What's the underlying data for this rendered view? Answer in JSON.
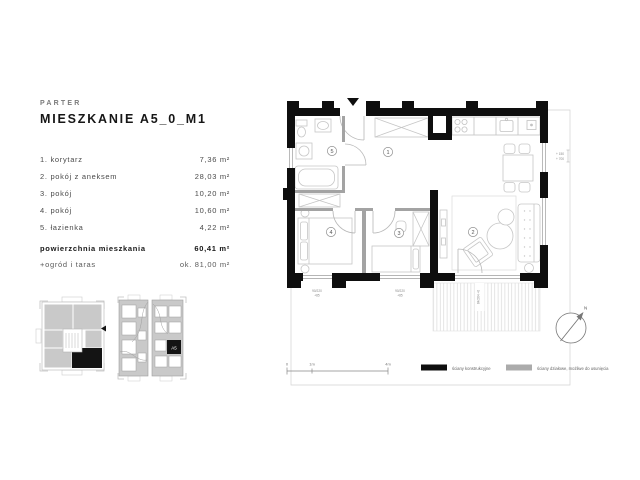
{
  "colors": {
    "ink": "#161616",
    "muted_gray": "#7b7b7b",
    "structural_wall": "#0e0e0e",
    "partition_wall": "#a3a3a3",
    "furniture_line": "#c6c6c6",
    "thumb_gray": "#c9c9c9"
  },
  "panel": {
    "floor_label": "PARTER",
    "title": "MIESZKANIE A5_0_M1",
    "rooms": [
      {
        "name": "1. korytarz",
        "area": "7,36 m²"
      },
      {
        "name": "2. pokój z aneksem",
        "area": "28,03 m²"
      },
      {
        "name": "3. pokój",
        "area": "10,20 m²"
      },
      {
        "name": "4. pokój",
        "area": "10,60 m²"
      },
      {
        "name": "5. łazienka",
        "area": "4,22 m²"
      }
    ],
    "total_label": "powierzchnia mieszkania",
    "total_area": "60,41 m²",
    "garden_label": "+ogród i taras",
    "garden_area": "ok. 81,00 m²",
    "unit_marker": "A5"
  },
  "plan": {
    "room_numbers": [
      "1",
      "2",
      "3",
      "4",
      "5"
    ],
    "north_label": "N",
    "window_dims": {
      "room4": [
        "90/220",
        "+85"
      ],
      "room3": [
        "90/220",
        "+85"
      ],
      "terrace": "84/264 +0"
    },
    "right_window_note": [
      "+ 150",
      "+ 700"
    ],
    "scalebar": {
      "zero": "0",
      "one": "1m",
      "four": "4m"
    }
  },
  "legend": {
    "structural": "ściany konstrukcyjne",
    "partition": "ściany działowe, możliwe do usunięcia"
  }
}
